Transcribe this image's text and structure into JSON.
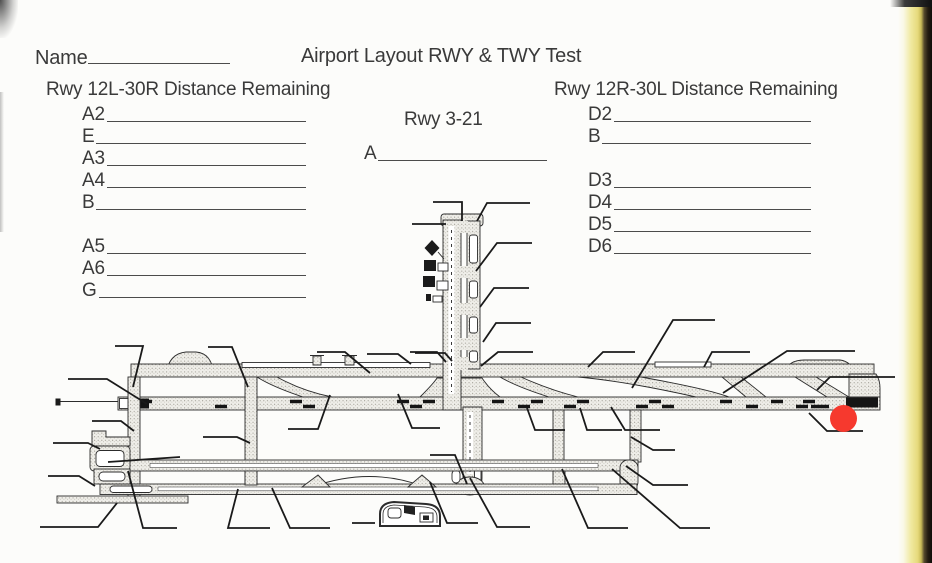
{
  "colors": {
    "paper": "#fcfcfa",
    "ink": "#3a3a3a",
    "marker_red": "#f6392e",
    "page_edge_yellow": "#e6da7c"
  },
  "document": {
    "name_label": "Name",
    "title": "Airport Layout RWY & TWY Test"
  },
  "sections": {
    "left": {
      "heading": "Rwy 12L-30R Distance Remaining",
      "items": [
        {
          "label": "A2"
        },
        {
          "label": "E"
        },
        {
          "label": "A3"
        },
        {
          "label": "A4"
        },
        {
          "label": "B"
        },
        {
          "label": "A5",
          "gap_before": true
        },
        {
          "label": "A6"
        },
        {
          "label": "G"
        }
      ]
    },
    "center": {
      "heading": "Rwy 3-21",
      "items": [
        {
          "label": "A"
        }
      ]
    },
    "right": {
      "heading": "Rwy 12R-30L Distance Remaining",
      "items": [
        {
          "label": "D2"
        },
        {
          "label": "B"
        },
        {
          "label": "D3",
          "gap_before": true
        },
        {
          "label": "D4"
        },
        {
          "label": "D5"
        },
        {
          "label": "D6"
        }
      ]
    }
  },
  "diagram": {
    "description": "Black-and-white airport layout diagram with two parallel horizontal runways, a crossing vertical runway (Rwy 3-21), parallel taxiways, terminal apron, and many unlabeled callout lines",
    "marker": "red-dot"
  }
}
